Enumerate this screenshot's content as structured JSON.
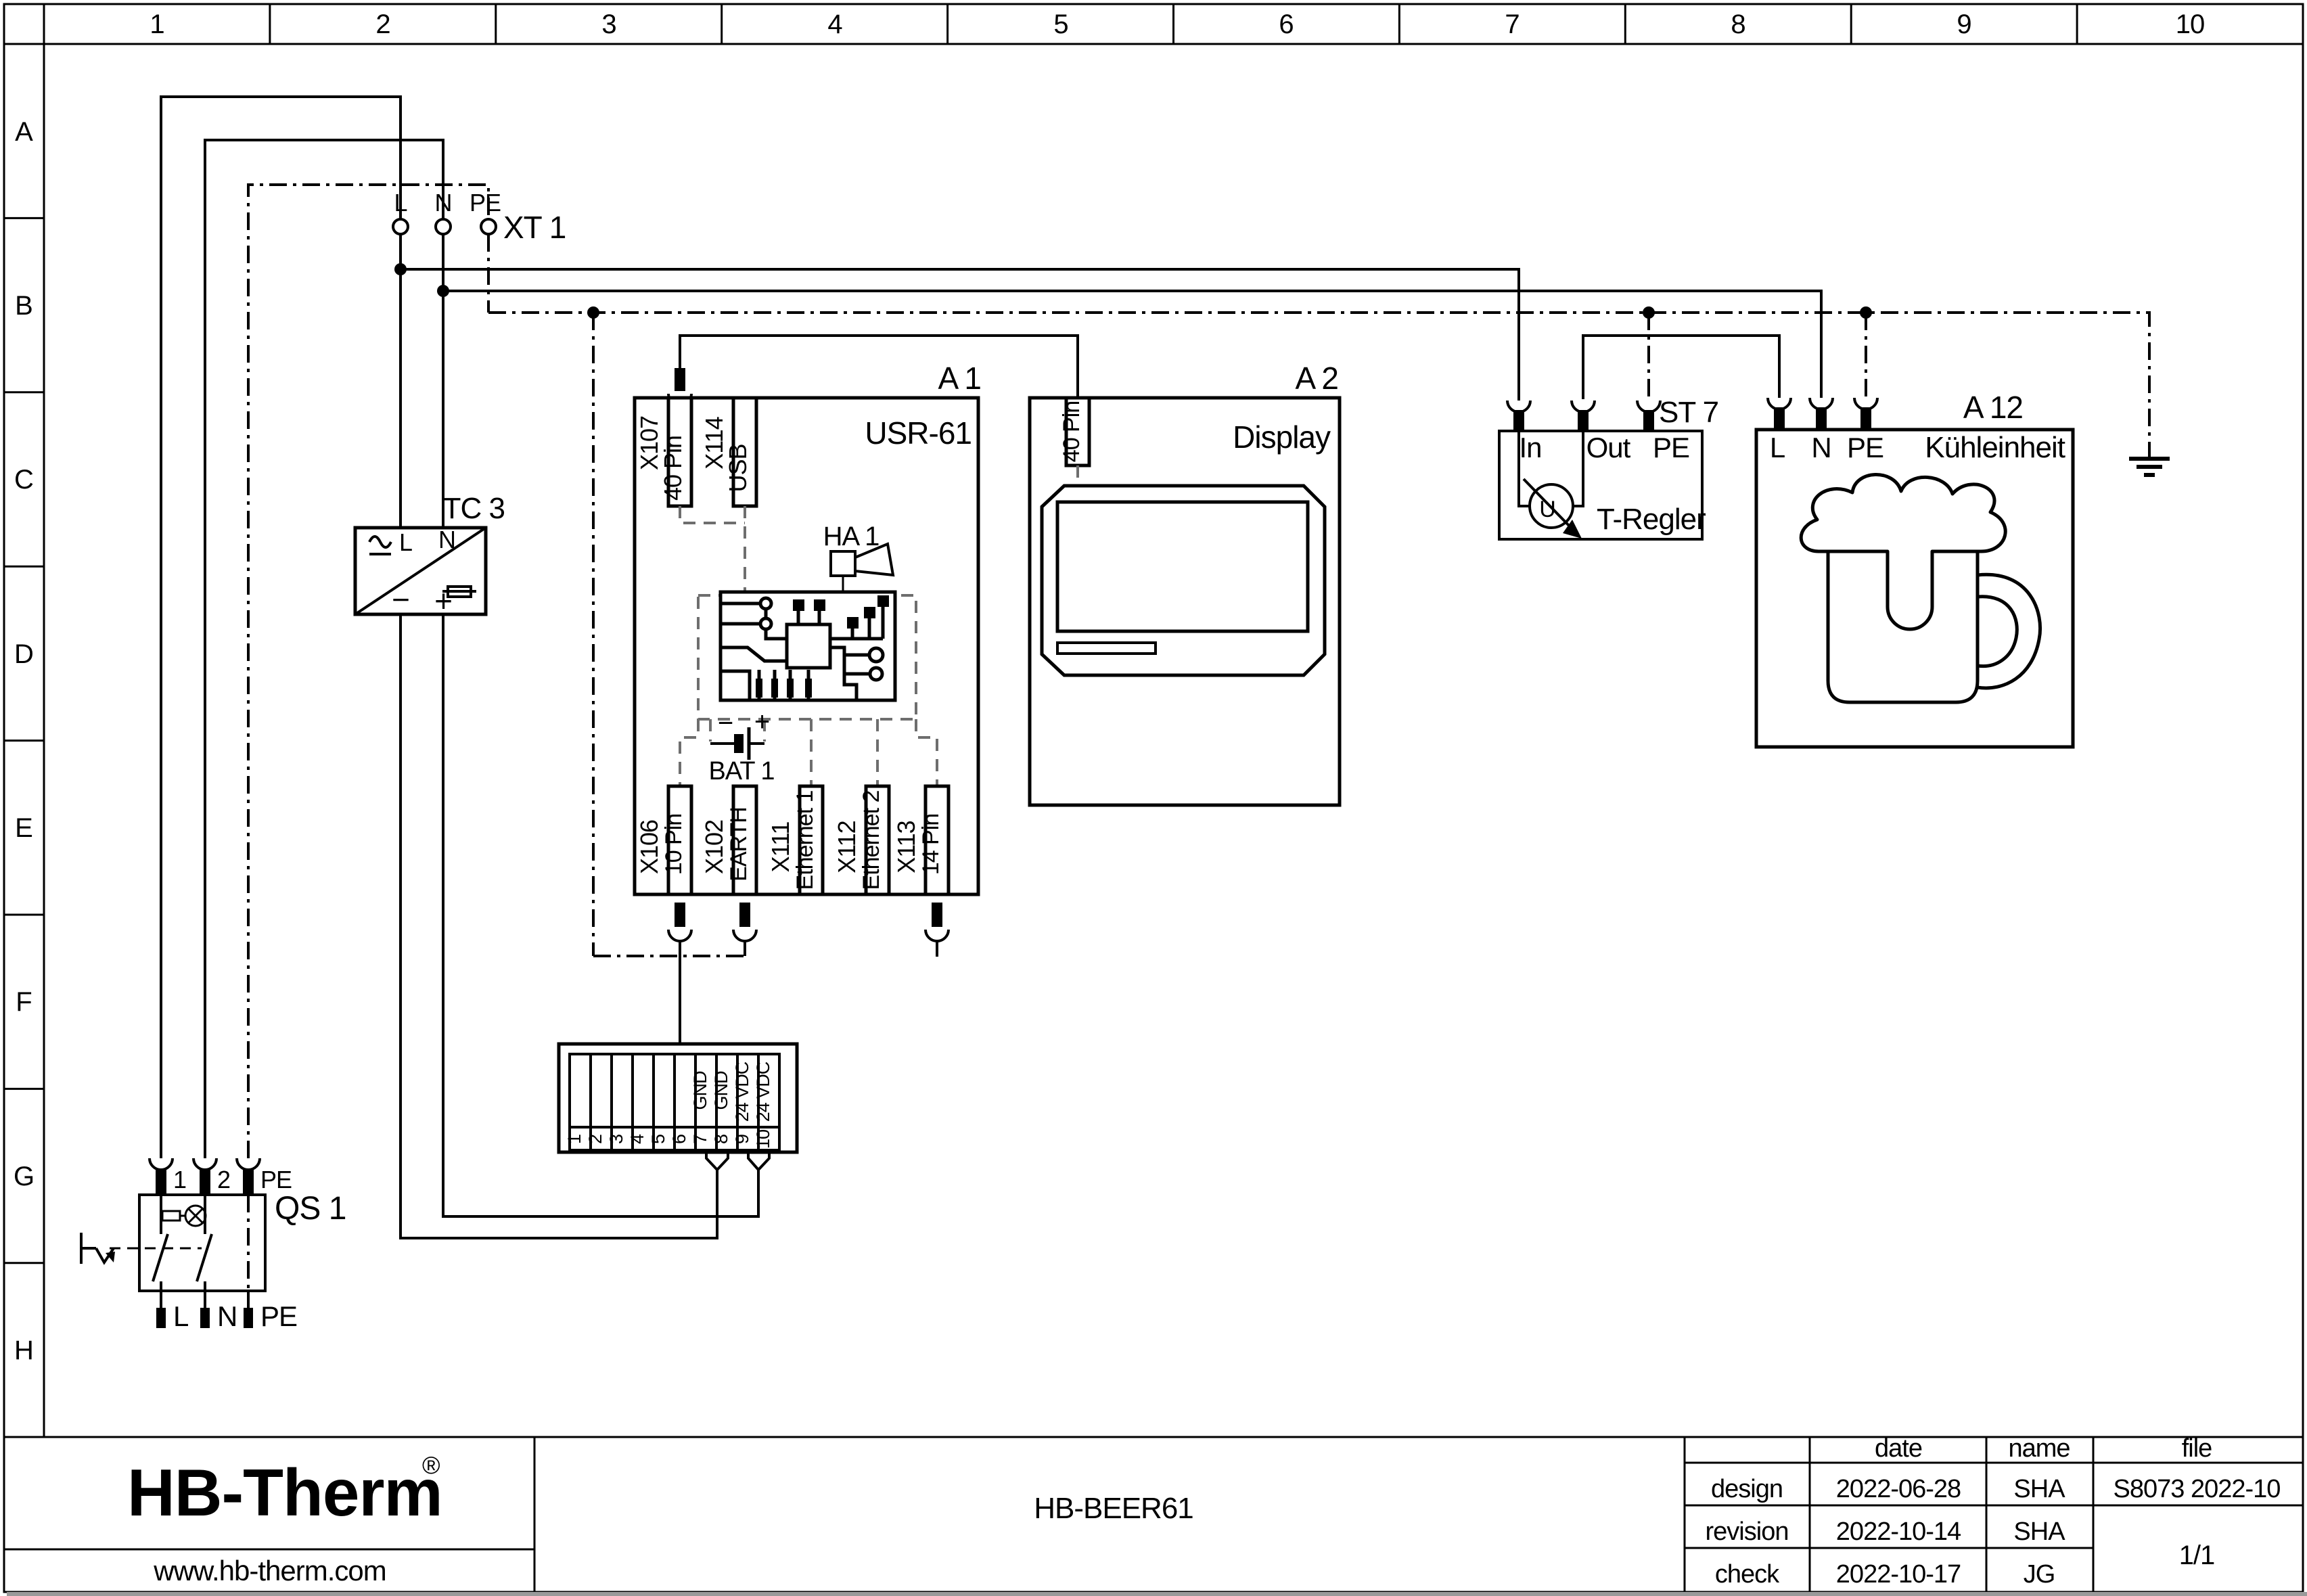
{
  "colors": {
    "logo": "#1c2a5a"
  },
  "sheet": {
    "columns": [
      "1",
      "2",
      "3",
      "4",
      "5",
      "6",
      "7",
      "8",
      "9",
      "10"
    ],
    "rows": [
      "A",
      "B",
      "C",
      "D",
      "E",
      "F",
      "G",
      "H"
    ]
  },
  "components": {
    "xt1": {
      "ref": "XT 1",
      "l": "L",
      "n": "N",
      "pe": "PE"
    },
    "tc3": {
      "ref": "TC 3",
      "l": "L",
      "n": "N",
      "minus": "−",
      "plus": "+"
    },
    "qs1": {
      "ref": "QS 1",
      "t1": "1",
      "t2": "2",
      "tpe": "PE",
      "bl": "L",
      "bn": "N",
      "bpe": "PE"
    },
    "a1": {
      "ref": "A 1",
      "title": "USR-61",
      "x107": {
        "id": "X107",
        "desc": "40 Pin"
      },
      "x114": {
        "id": "X114",
        "desc": "USB"
      },
      "ha1": "HA 1",
      "bat1": "BAT 1",
      "x106": {
        "id": "X106",
        "desc": "10 Pin"
      },
      "x102": {
        "id": "X102",
        "desc": "EARTH"
      },
      "x111": {
        "id": "X111",
        "desc": "Ethernet 1"
      },
      "x112": {
        "id": "X112",
        "desc": "Ethernet 2"
      },
      "x113": {
        "id": "X113",
        "desc": "14 Pin"
      }
    },
    "a2": {
      "ref": "A 2",
      "title": "Display",
      "conn": "40 Pin"
    },
    "st7": {
      "ref": "ST 7",
      "in": "In",
      "out": "Out",
      "pe": "PE",
      "name": "T-Regler",
      "dial": "U"
    },
    "a12": {
      "ref": "A 12",
      "title": "Kühleinheit",
      "l": "L",
      "n": "N",
      "pe": "PE"
    },
    "terminal_block": {
      "numbers": [
        "1",
        "2",
        "3",
        "4",
        "5",
        "6",
        "7",
        "8",
        "9",
        "10"
      ],
      "cell_labels": [
        "GND",
        "GND",
        "24 VDC",
        "24 VDC"
      ]
    }
  },
  "title_block": {
    "logo": "HB-Therm",
    "logo_reg": "®",
    "website": "www.hb-therm.com",
    "drawing_title": "HB-BEER61",
    "col_date": "date",
    "col_name": "name",
    "col_file": "file",
    "rows": [
      {
        "label": "design",
        "date": "2022-06-28",
        "name": "SHA"
      },
      {
        "label": "revision",
        "date": "2022-10-14",
        "name": "SHA"
      },
      {
        "label": "check",
        "date": "2022-10-17",
        "name": "JG"
      }
    ],
    "file_value": "S8073 2022-10",
    "page": "1/1"
  }
}
